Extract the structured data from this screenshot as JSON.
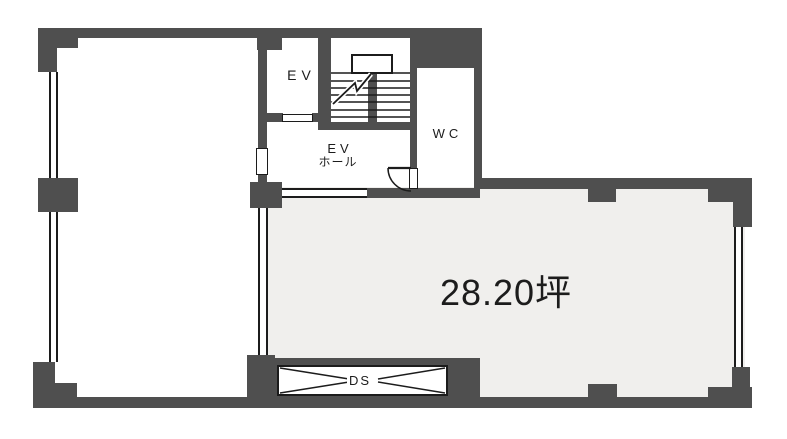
{
  "plan": {
    "type": "building-floor-plan",
    "rooms": {
      "elevator": {
        "label": "EV"
      },
      "ev_hall": {
        "label_line1": "EV",
        "label_line2": "ホール"
      },
      "wc": {
        "label": "WC"
      },
      "main_room": {
        "area_label": "28.20坪"
      },
      "duct_space": {
        "label": "DS"
      }
    },
    "colors": {
      "wall": "#4f4f4f",
      "line": "#1c1c1c",
      "main_room_fill": "#f0efed",
      "background": "#ffffff",
      "text": "#1c1c1c"
    }
  }
}
